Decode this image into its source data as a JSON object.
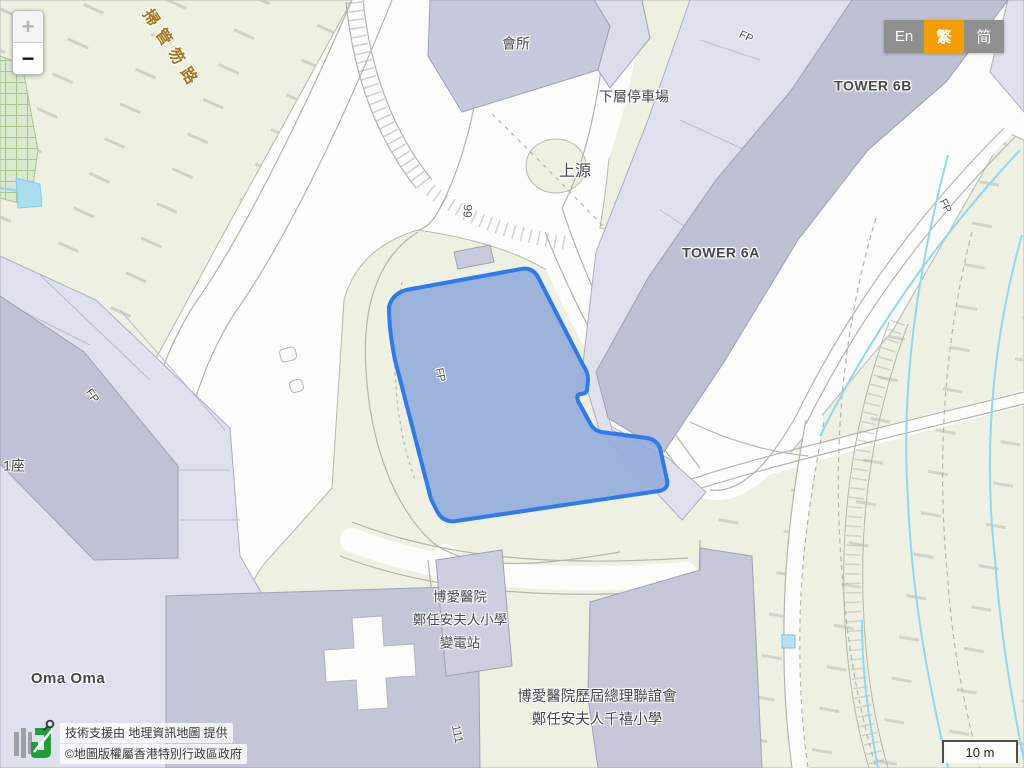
{
  "controls": {
    "zoom_in": "+",
    "zoom_out": "−"
  },
  "language_switcher": {
    "en": "En",
    "zh_traditional": "繁",
    "zh_simplified": "简",
    "active": "繁",
    "active_color": "#f59e00",
    "inactive_color": "#8f8f8f"
  },
  "attribution": {
    "support_line": "技術支援由 地理資訊地圖 提供",
    "copyright_line": "©地圖版權屬香港特別行政區政府",
    "logo": "geoinfo-map-logo"
  },
  "scale_bar": {
    "label": "10 m"
  },
  "map": {
    "road_name": "掃管笏路",
    "labels": {
      "clubhouse": "會所",
      "lower_carpark": "下層停車場",
      "estate_name": "上源",
      "tower_6b": "TOWER 6B",
      "tower_6a": "TOWER 6A",
      "block_1": "1座",
      "oma_oma": "Oma Oma",
      "footpath": "FP",
      "route_99": "99",
      "route_111": "111",
      "substation": [
        "博愛醫院",
        "鄭任安夫人小學",
        "變電站"
      ],
      "school": [
        "博愛醫院歷屆總理聯誼會",
        "鄭任安夫人千禧小學"
      ]
    },
    "selection": {
      "stroke_color": "#2d7af0",
      "fill_color": "#94add9"
    }
  }
}
